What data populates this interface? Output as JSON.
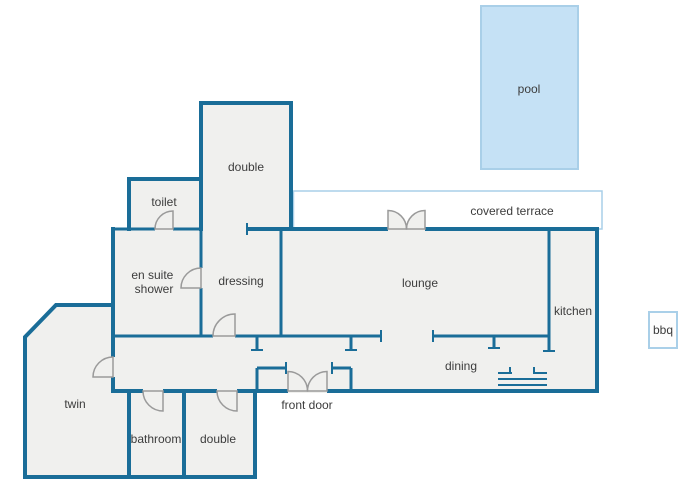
{
  "title": "villa floor plan",
  "theme": {
    "wall_color": "#1a6d98",
    "room_fill": "#f0f0ee",
    "pool_fill": "#c5e1f5",
    "pool_border": "#a9cfe8",
    "door_color": "#9a9a9a",
    "text_color": "#3c3c3c"
  },
  "rooms": {
    "pool": {
      "label": "pool"
    },
    "covered_terrace": {
      "label": "covered terrace"
    },
    "double_top": {
      "label": "double"
    },
    "toilet": {
      "label": "toilet"
    },
    "en_suite": {
      "line1": "en suite",
      "line2": "shower"
    },
    "dressing": {
      "label": "dressing"
    },
    "lounge": {
      "label": "lounge"
    },
    "kitchen": {
      "label": "kitchen"
    },
    "dining": {
      "label": "dining"
    },
    "front_door": {
      "label": "front door"
    },
    "twin": {
      "label": "twin"
    },
    "bathroom": {
      "label": "bathroom"
    },
    "double_bottom": {
      "label": "double"
    },
    "bbq": {
      "label": "bbq"
    }
  }
}
